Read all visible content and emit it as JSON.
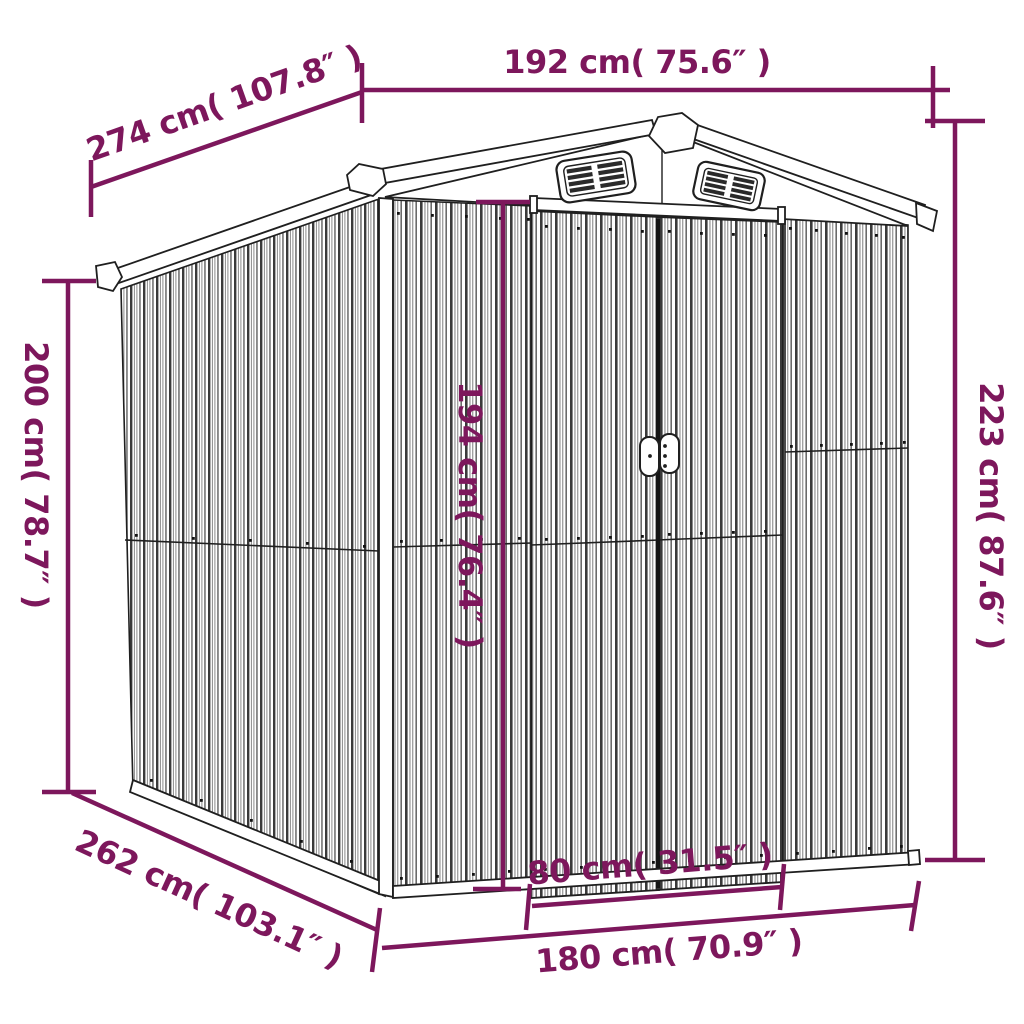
{
  "diagram": {
    "type": "product-dimension-diagram",
    "subject": "metal garden shed with gable roof, two louver vents and sliding double doors",
    "colors": {
      "dimension_annotation": "#7d175c",
      "line_art": "#1f1f1f",
      "background": "#ffffff"
    },
    "dimensions": [
      {
        "id": "roof-width-top",
        "label": "192 cm( 75.6″ )",
        "value_cm": 192,
        "value_in": 75.6,
        "orientation": "horizontal",
        "position": "top"
      },
      {
        "id": "roof-depth",
        "label": "274 cm( 107.8″ )",
        "value_cm": 274,
        "value_in": 107.8,
        "orientation": "diagonal",
        "position": "top-left"
      },
      {
        "id": "wall-height",
        "label": "200 cm( 78.7″ )",
        "value_cm": 200,
        "value_in": 78.7,
        "orientation": "vertical",
        "position": "left"
      },
      {
        "id": "total-height",
        "label": "223 cm( 87.6″ )",
        "value_cm": 223,
        "value_in": 87.6,
        "orientation": "vertical",
        "position": "right"
      },
      {
        "id": "door-height",
        "label": "194 cm( 76.4″ )",
        "value_cm": 194,
        "value_in": 76.4,
        "orientation": "vertical",
        "position": "center"
      },
      {
        "id": "door-width",
        "label": "80 cm( 31.5″ )",
        "value_cm": 80,
        "value_in": 31.5,
        "orientation": "horizontal",
        "position": "bottom-center"
      },
      {
        "id": "base-width",
        "label": "180 cm( 70.9″ )",
        "value_cm": 180,
        "value_in": 70.9,
        "orientation": "horizontal",
        "position": "bottom"
      },
      {
        "id": "base-depth",
        "label": "262 cm( 103.1″ )",
        "value_cm": 262,
        "value_in": 103.1,
        "orientation": "diagonal",
        "position": "bottom-left"
      }
    ]
  }
}
